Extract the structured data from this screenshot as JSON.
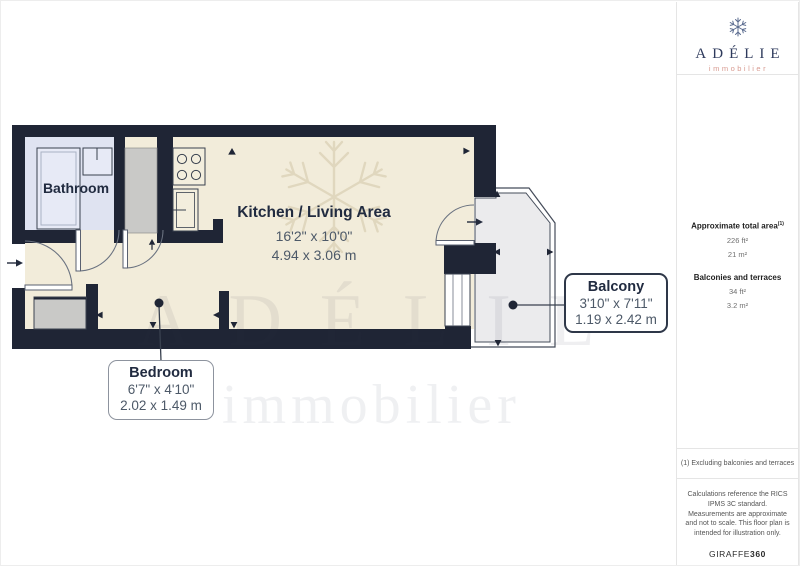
{
  "branding": {
    "name": "ADÉLIE",
    "tagline": "immobilier",
    "brand_navy": "#2e3a5c",
    "brand_salmon": "#d89b91"
  },
  "watermark": {
    "title": "ADÉLIE",
    "subtitle": "immobilier"
  },
  "plan": {
    "rooms": {
      "bathroom": {
        "label": "Bathroom"
      },
      "kitchen_living": {
        "label": "Kitchen / Living Area",
        "size_imperial": "16'2\" x 10'0\"",
        "size_metric": "4.94 x 3.06 m"
      },
      "balcony": {
        "label": "Balcony",
        "size_imperial": "3'10\" x 7'11\"",
        "size_metric": "1.19 x 2.42 m"
      },
      "bedroom": {
        "label": "Bedroom",
        "size_imperial": "6'7\" x 4'10\"",
        "size_metric": "2.02 x 1.49 m"
      }
    },
    "colors": {
      "wall": "#1f2535",
      "floor": "#f2ecda",
      "bathroom_floor": "#dfe3f1",
      "balcony_floor": "#ebebed",
      "furniture_gray": "#c9c9c7"
    }
  },
  "sidebar": {
    "total_area": {
      "label": "Approximate total area",
      "footnote_marker": "(1)",
      "imperial": "226 ft²",
      "metric": "21 m²"
    },
    "balconies": {
      "label": "Balconies and terraces",
      "imperial": "34 ft²",
      "metric": "3.2 m²"
    },
    "footnote": "(1) Excluding balconies and terraces",
    "disclaimer": "Calculations reference the RICS IPMS 3C standard. Measurements are approximate and not to scale. This floor plan is intended for illustration only.",
    "provider": "GIRAFFE",
    "provider_suffix": "360"
  }
}
